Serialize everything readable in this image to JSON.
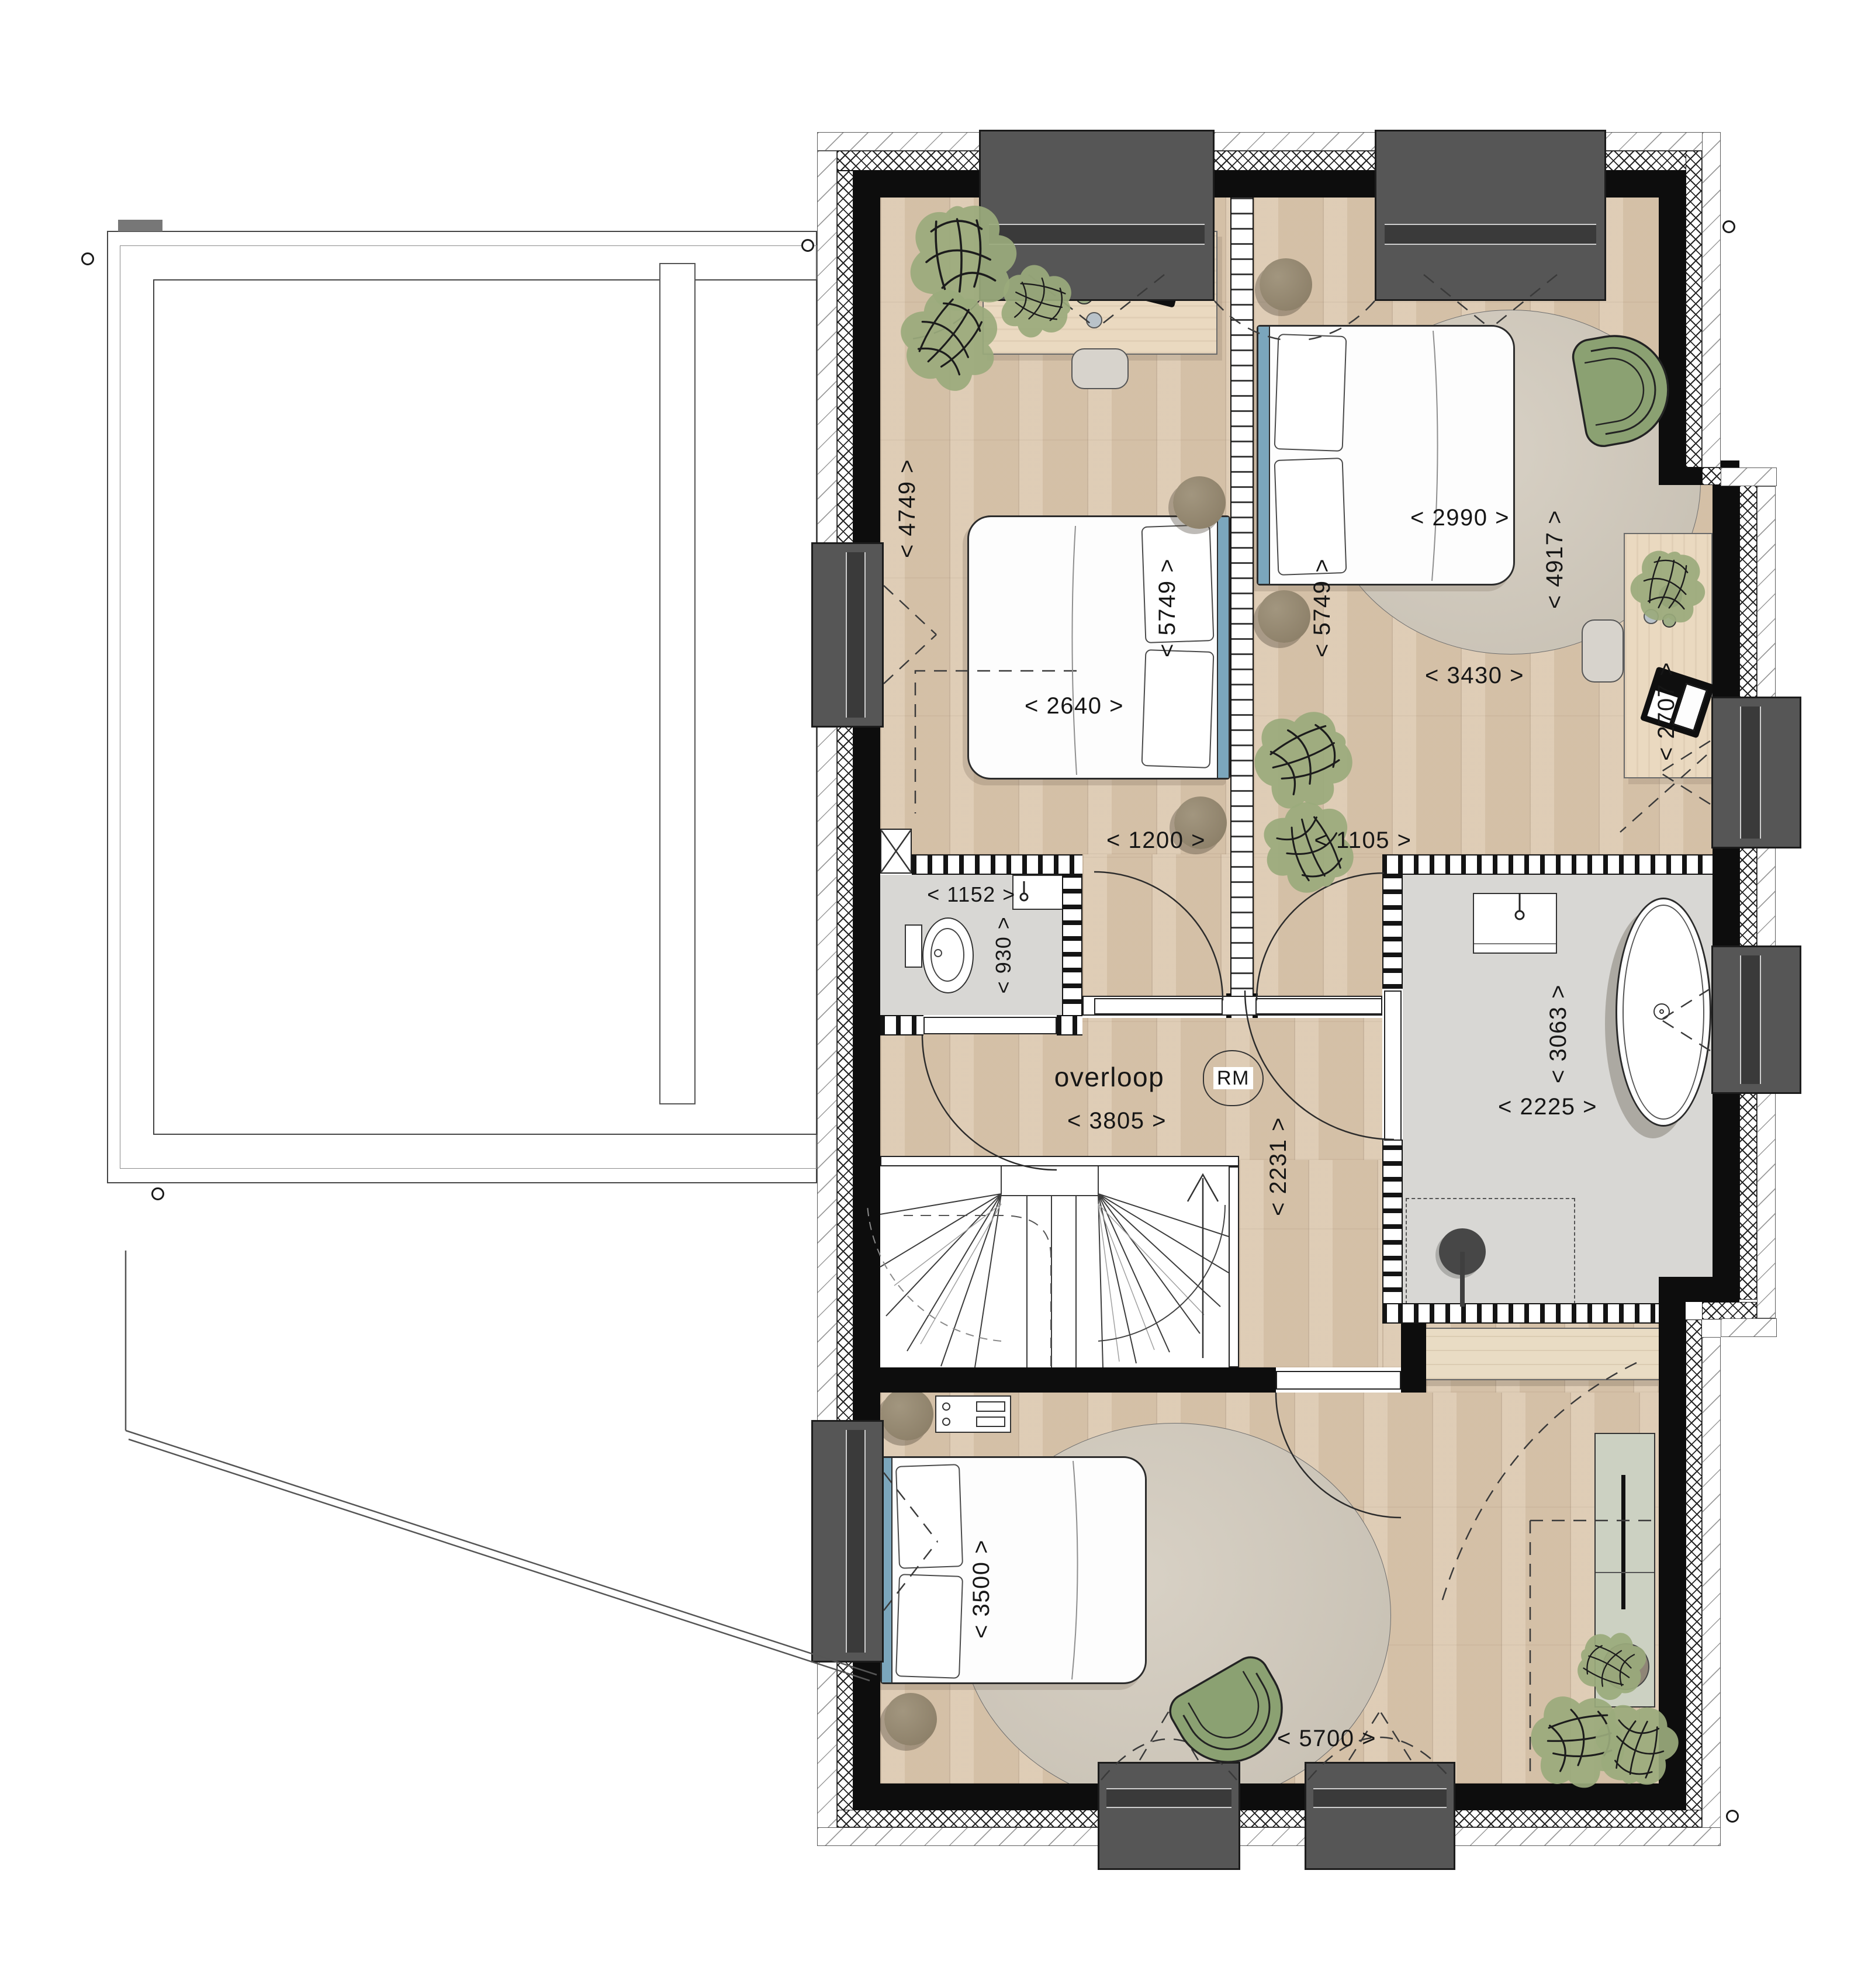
{
  "document": {
    "kind": "architectural floor plan, upper storey (attic) of a dwelling",
    "room_label": "overloop",
    "smoke_detector_badge": "RM"
  },
  "labels": [
    {
      "id": "dim-4749",
      "text": "< 4749 >"
    },
    {
      "id": "dim-2640",
      "text": "< 2640 >"
    },
    {
      "id": "dim-5749-a",
      "text": "< 5749 >"
    },
    {
      "id": "dim-5749-b",
      "text": "< 5749 >"
    },
    {
      "id": "dim-2990",
      "text": "< 2990 >"
    },
    {
      "id": "dim-4917",
      "text": "< 4917 >"
    },
    {
      "id": "dim-3430",
      "text": "< 3430 >"
    },
    {
      "id": "dim-2707",
      "text": "< 2707 >"
    },
    {
      "id": "dim-1200",
      "text": "< 1200 >"
    },
    {
      "id": "dim-1105",
      "text": "< 1105 >"
    },
    {
      "id": "dim-1152",
      "text": "< 1152 >"
    },
    {
      "id": "dim-930",
      "text": "< 930 >"
    },
    {
      "id": "room-overloop",
      "text": "overloop"
    },
    {
      "id": "dim-3805",
      "text": "< 3805 >"
    },
    {
      "id": "badge-rm",
      "text": "RM"
    },
    {
      "id": "dim-2231",
      "text": "< 2231 >"
    },
    {
      "id": "dim-3063",
      "text": "< 3063 >"
    },
    {
      "id": "dim-2225",
      "text": "< 2225 >"
    },
    {
      "id": "dim-3500",
      "text": "< 3500 >"
    },
    {
      "id": "dim-5700",
      "text": "< 5700 >"
    }
  ],
  "colors": {
    "wall": "#0d0d0d",
    "wood_floor": "#dbc7ae",
    "tile_floor": "#d8d7d4",
    "window_frame": "#565656",
    "plant_green": "#9aaa7c",
    "chair_green": "#8ba172",
    "headboard_blue": "#7ba6bc",
    "rug": "#cdc6ba"
  }
}
